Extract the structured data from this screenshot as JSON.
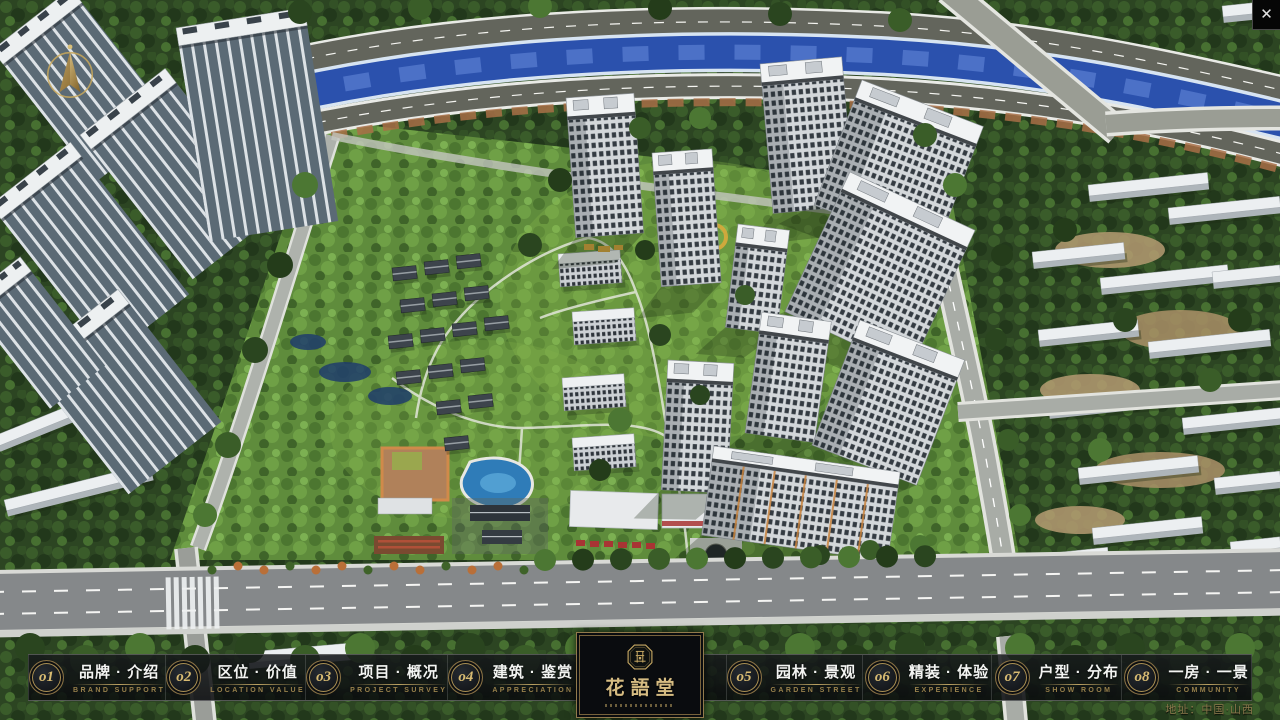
{
  "app": {
    "close_glyph": "✕"
  },
  "nav": {
    "items": [
      {
        "num": "o1",
        "cn": "品牌 · 介绍",
        "en": "BRAND SUPPORT"
      },
      {
        "num": "o2",
        "cn": "区位 · 价值",
        "en": "LOCATION VALUE"
      },
      {
        "num": "o3",
        "cn": "项目 · 概况",
        "en": "PROJECT SURVEY"
      },
      {
        "num": "o4",
        "cn": "建筑 · 鉴赏",
        "en": "APPRECIATION"
      },
      {
        "num": "o5",
        "cn": "园林 · 景观",
        "en": "GARDEN STREET"
      },
      {
        "num": "o6",
        "cn": "精装 · 体验",
        "en": "EXPERIENCE"
      },
      {
        "num": "o7",
        "cn": "户型 · 分布",
        "en": "SHOW ROOM"
      },
      {
        "num": "o8",
        "cn": "一房 · 一景",
        "en": "COMMUNITY"
      }
    ]
  },
  "logo": {
    "title": "花語堂"
  },
  "footer": {
    "address": "地址：中国·山西"
  },
  "colors": {
    "gold": "#c2a262",
    "gold_dim": "#97804b",
    "bar_bg": "rgba(14,16,19,0.85)",
    "river": "#2b51ad",
    "lawn": "#5f8c3c",
    "tree_dark": "#2c4522",
    "roof_white": "#f1f3f4",
    "facade": "#d3d7da"
  }
}
